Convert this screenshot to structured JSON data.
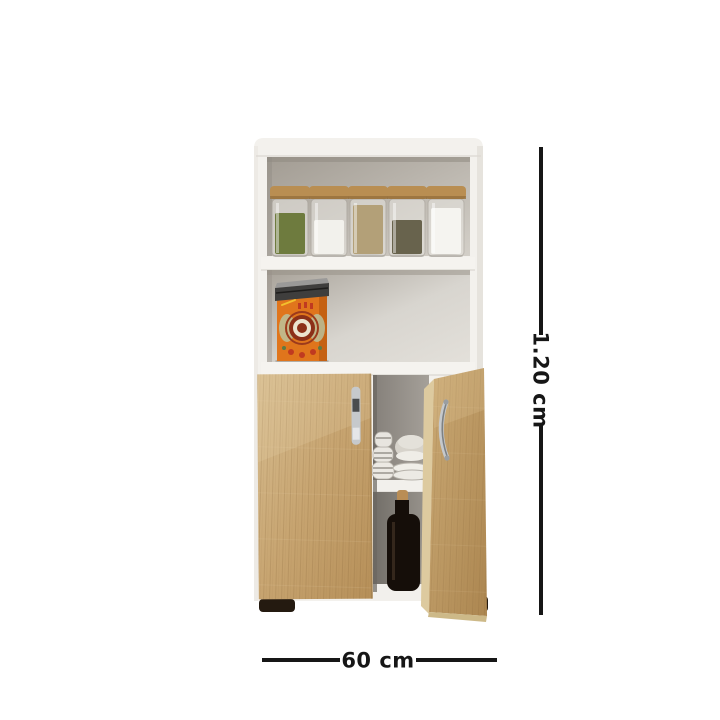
{
  "scene": {
    "kind": "product-dimension-diagram",
    "product": "kitchen storage cabinet with open shelves and two wood doors",
    "background": "#ffffff"
  },
  "dimensions": {
    "height": {
      "label": "1.20 cm"
    },
    "width": {
      "label": "60 cm"
    }
  },
  "colors": {
    "line": "#161616",
    "carcass": "#f3f1ed",
    "jar_lid": "#b98e52",
    "tin_body": "#e0751c",
    "tin_lid": "#3f3e3d",
    "bottle": "#150e09",
    "cork": "#b98d55",
    "foot": "#241a10",
    "wood_light": "#d7bc8e",
    "wood_dark": "#b08a52",
    "handle": "#c6c9cc"
  },
  "jars": [
    {
      "name": "jar-green-herbs",
      "color": "#6e7b3e"
    },
    {
      "name": "jar-white-salt",
      "color": "#f2f1ec"
    },
    {
      "name": "jar-brown-grains",
      "color": "#b3a078"
    },
    {
      "name": "jar-dark-seeds",
      "color": "#68634d"
    },
    {
      "name": "jar-white-sugar",
      "color": "#f5f4f0"
    }
  ]
}
